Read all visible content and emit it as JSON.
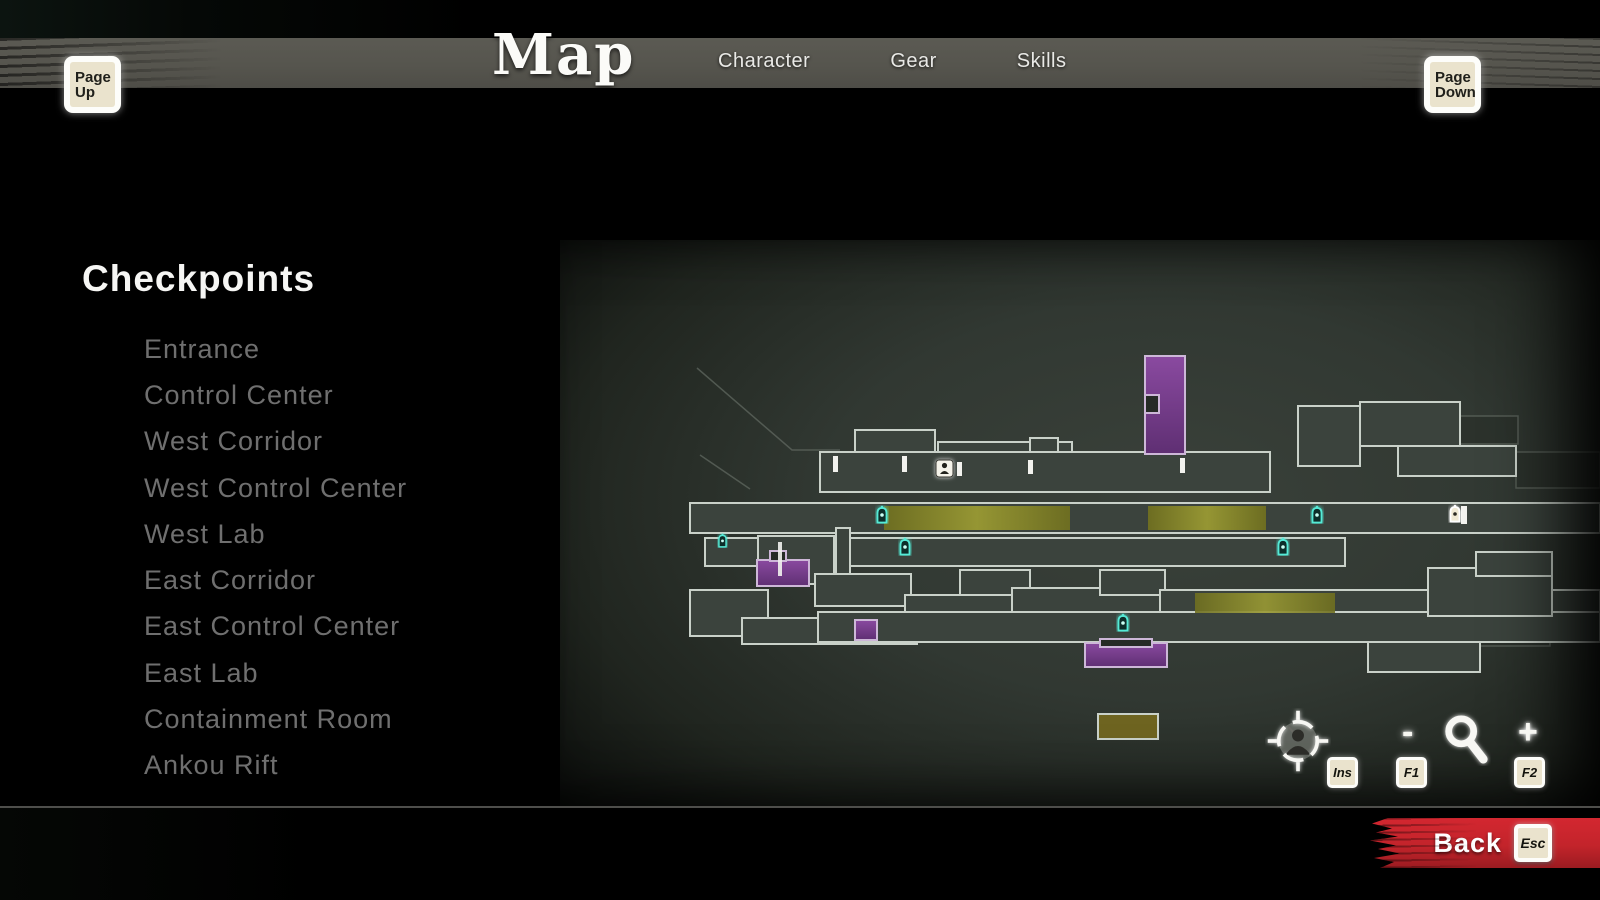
{
  "header": {
    "title": "Map",
    "tabs": [
      {
        "label": "Character"
      },
      {
        "label": "Gear"
      },
      {
        "label": "Skills"
      }
    ],
    "page_up": {
      "line1": "Page",
      "line2": "Up"
    },
    "page_down": {
      "line1": "Page",
      "line2": "Down"
    }
  },
  "collectibles": {
    "groups": [
      {
        "name": "Elite Squads",
        "icon": "elite-squad-icon",
        "count": 3
      },
      {
        "name": "Secrets",
        "icon": "secret-chest-icon",
        "count": 2
      },
      {
        "name": "Oboro Relics",
        "icon": "oboro-relic-icon",
        "count": 5
      },
      {
        "name": "Ankou Rift",
        "icon": "ankou-rift-icon",
        "count": 1
      }
    ]
  },
  "checkpoints": {
    "heading": "Checkpoints",
    "items": [
      "Entrance",
      "Control Center",
      "West Corridor",
      "West Control Center",
      "West Lab",
      "East Corridor",
      "East Control Center",
      "East Lab",
      "Containment Room",
      "Ankou Rift"
    ]
  },
  "map": {
    "cyan_lantern_marker_count": 6,
    "white_lantern_marker_count": 1
  },
  "map_controls": {
    "center_key": "Ins",
    "zoom_out_symbol": "-",
    "zoom_out_key": "F1",
    "zoom_in_symbol": "+",
    "zoom_in_key": "F2"
  },
  "footer": {
    "back_label": "Back",
    "back_key": "Esc"
  },
  "colors": {
    "accent_red": "#c1272d",
    "key_badge": "#eae3cd",
    "header_bar": "#56554e",
    "lantern_cyan": "#52e8d4",
    "room_purple": "#7b3f8e",
    "corridor_yellow": "#8d8d2f",
    "relic_gold": "#d9b63a"
  }
}
